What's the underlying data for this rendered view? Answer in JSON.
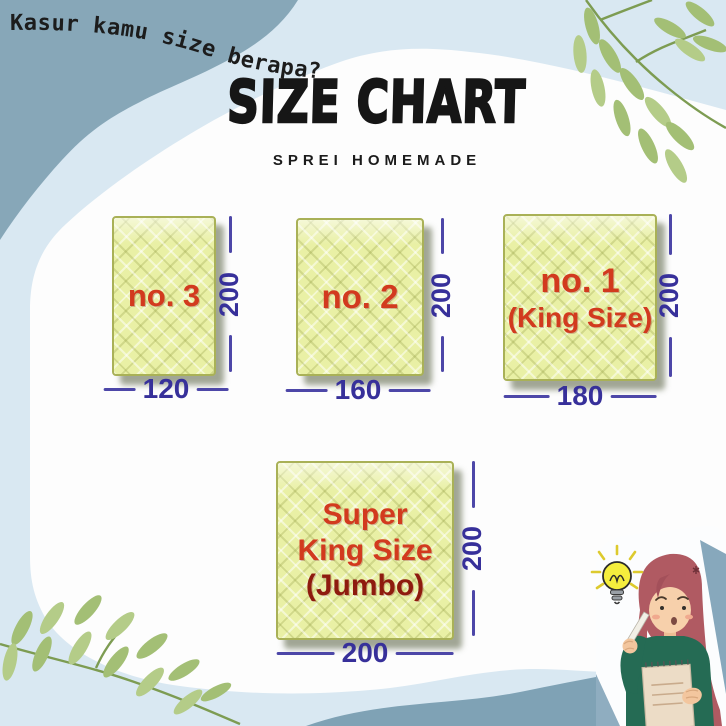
{
  "header": {
    "handwritten_question": "Kasur kamu size berapa?",
    "title": "SIZE CHART",
    "subtitle": "SPREI HOMEMADE"
  },
  "chart_data": {
    "type": "table",
    "title": "SIZE CHART",
    "subtitle": "SPREI HOMEMADE",
    "items": [
      {
        "name": "no. 3",
        "label_lines": [
          "no. 3"
        ],
        "width": 120,
        "height": 200
      },
      {
        "name": "no. 2",
        "label_lines": [
          "no. 2"
        ],
        "width": 160,
        "height": 200
      },
      {
        "name": "no. 1 (King Size)",
        "label_lines": [
          "no. 1",
          "(King Size)"
        ],
        "width": 180,
        "height": 200
      },
      {
        "name": "Super King Size (Jumbo)",
        "label_lines": [
          "Super",
          "King Size",
          "(Jumbo)"
        ],
        "width": 200,
        "height": 200
      }
    ]
  },
  "colors": {
    "background_blue": "#d9e8f2",
    "corner_blue_gray": "#87a7b8",
    "wave_blue_gray": "#7fa2b5",
    "card_white": "#fdfdfd",
    "mattress_fill": "#e9f0a5",
    "mattress_border": "#a9b157",
    "label_red": "#d23a1e",
    "label_dark_red": "#8e1b0e",
    "dimension_indigo": "#37309a",
    "leaf_green": "#a3bf75",
    "bulb_yellow": "#f5ee3d"
  },
  "icons": {
    "top_right": "leaf-branch-icon",
    "bottom_left": "leaf-branch-icon",
    "idea": "lightbulb-icon",
    "mascot": "thinking-woman-illustration"
  }
}
